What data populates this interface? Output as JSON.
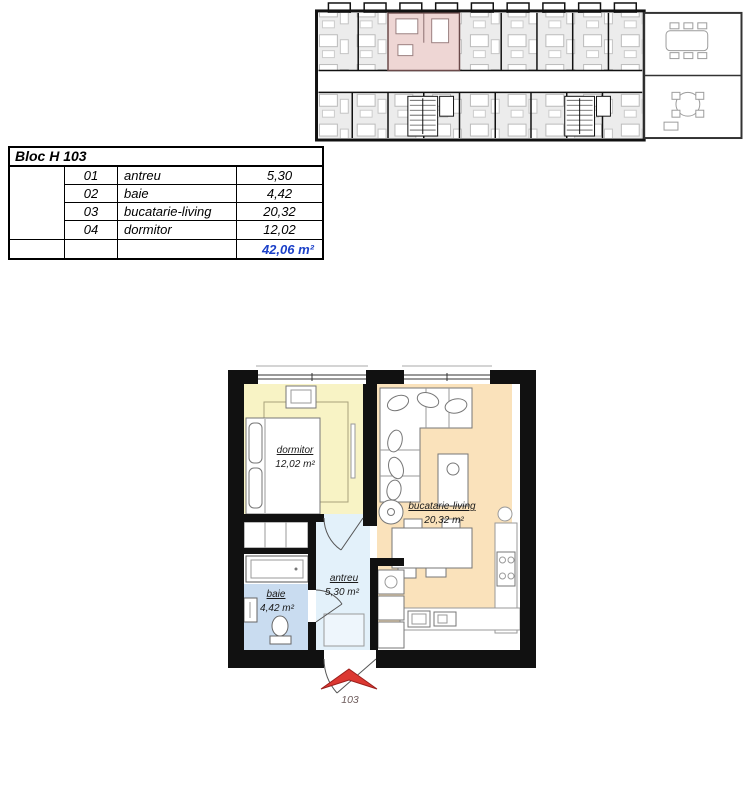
{
  "colors": {
    "wall": "#111111",
    "dormitor-fill": "#f8f3c5",
    "bucatarie-fill": "#fae2bb",
    "baie-fill": "#c9dcf0",
    "antreu-fill": "#e3f1fa",
    "highlight-pink": "#eed6d4",
    "overview-room": "#ececec",
    "total-blue": "#1b40c8",
    "arrow-red": "#dc3832"
  },
  "area_table": {
    "title": "Bloc H 103",
    "rows": [
      {
        "num": "01",
        "name": "antreu",
        "area": "5,30"
      },
      {
        "num": "02",
        "name": "baie",
        "area": "4,42"
      },
      {
        "num": "03",
        "name": "bucatarie-living",
        "area": "20,32"
      },
      {
        "num": "04",
        "name": "dormitor",
        "area": "12,02"
      }
    ],
    "total": "42,06 m²"
  },
  "apartment": {
    "rooms": [
      {
        "id": "dormitor",
        "label": "dormitor",
        "area": "12,02 m²"
      },
      {
        "id": "bucatarie-living",
        "label": "bucatarie-living",
        "area": "20,32 m²"
      },
      {
        "id": "baie",
        "label": "baie",
        "area": "4,42 m²"
      },
      {
        "id": "antreu",
        "label": "antreu",
        "area": "5,30 m²"
      }
    ],
    "entrance_label": "103"
  }
}
